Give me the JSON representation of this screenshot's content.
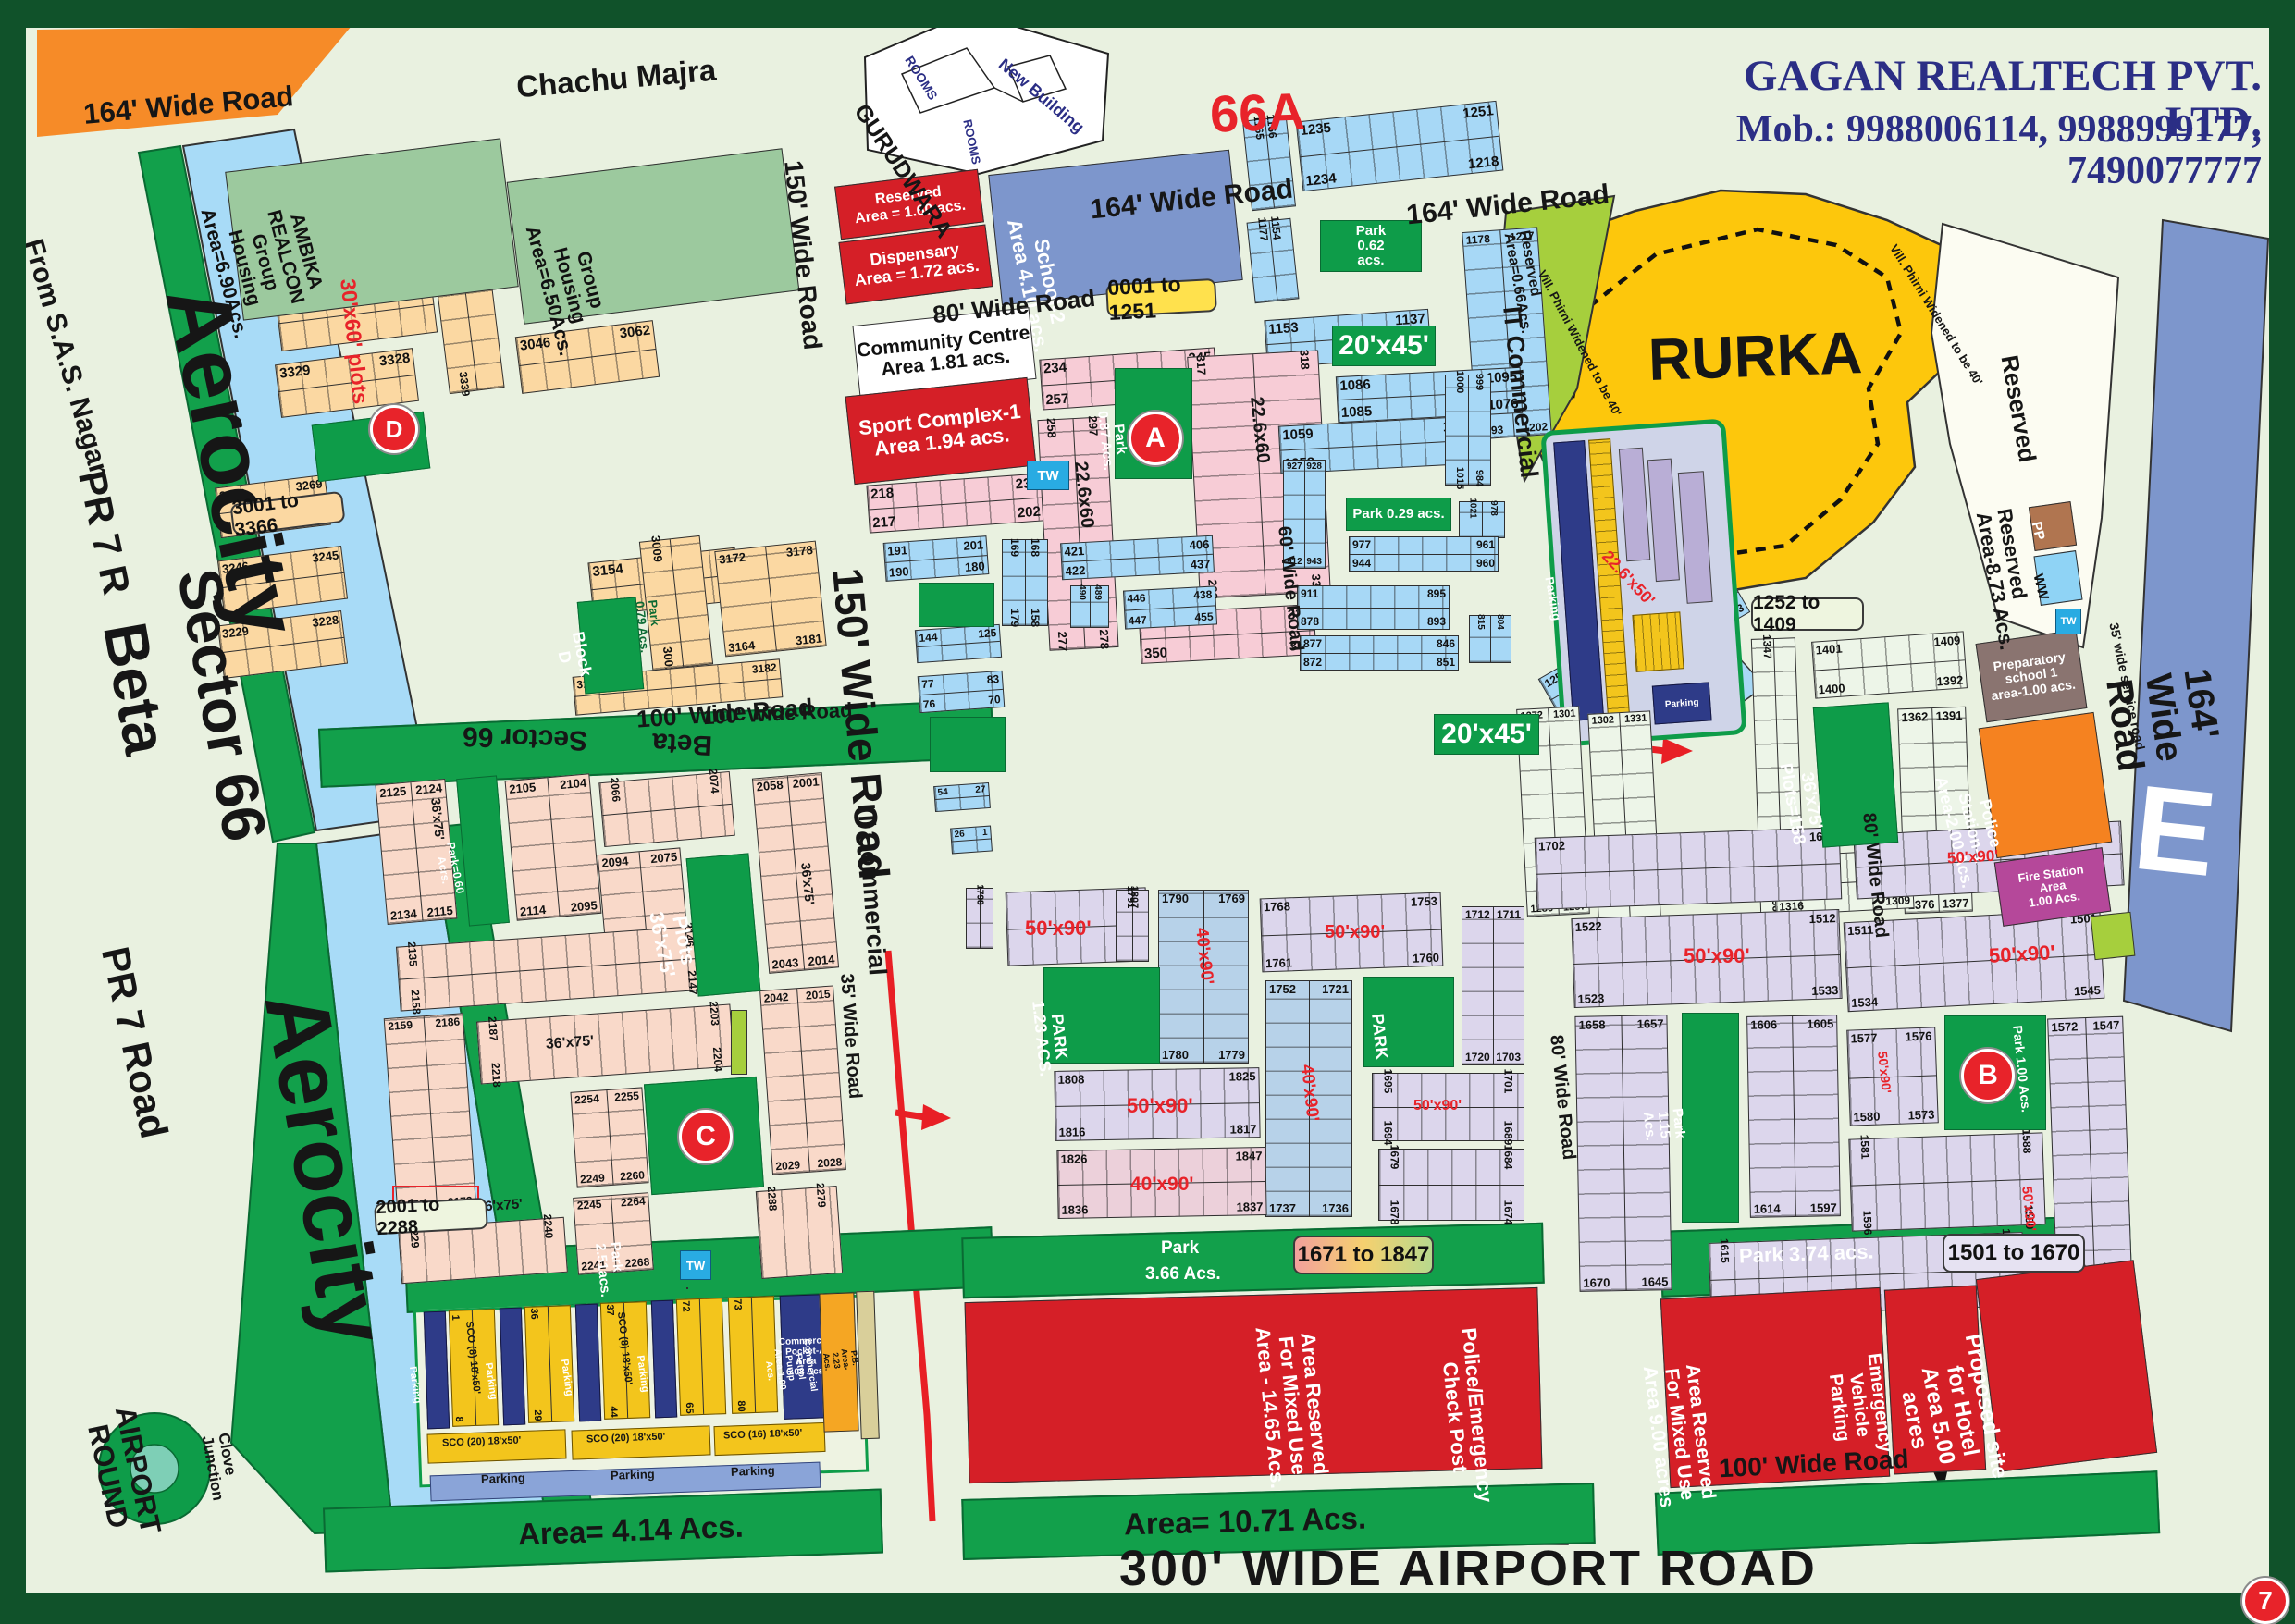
{
  "header": {
    "company": "GAGAN REALTECH PVT. LTD.",
    "phone": "Mob.: 9988006114, 9988999177, 7490077777",
    "sector_code": "66A",
    "village_top": "Chachu Majra",
    "page_no": "7"
  },
  "gurudwara": {
    "name": "GURUDWARA",
    "new_building": "New Building",
    "rooms": "ROOMS"
  },
  "roads": {
    "w164a": "164' Wide  Road",
    "w164b": "164' Wide Road",
    "w164c": "164' Wide Road",
    "w164d": "164' Wide Road",
    "w150a": "150' Wide Road",
    "w150b": "150' Wide Road",
    "w100a": "100' Wide Road",
    "w100b": "100' Wide Road",
    "w80a": "80' Wide Road",
    "w80b": "80' Wide Road",
    "w80c": "80' Wide Road",
    "w60": "60' Wide Road",
    "w35": "35' Wide Road",
    "service35": "35' wide service road",
    "airport": "300' WIDE AIRPORT ROAD",
    "it_comm": "IT Commercial",
    "phirni": "Vill. Phirni Widened to be 40'"
  },
  "left": {
    "from_sas": "From S.A.S. Nagar",
    "pr7r": "PR 7 R",
    "sector66": "Sector 66",
    "beta": "Beta",
    "aerocity": "Aerocity",
    "pr7road": "PR 7 Road",
    "airport_round": "AIRPORT\nROUND",
    "clove": "Clove\nJunction"
  },
  "areas": {
    "ambika": "AMBIKA\nREALCON\nGroup\nHousing\nArea=6.90Acs.",
    "gh650": "Group\nHousing\nArea=6.50Acs.",
    "reserved160": "Reserved\nArea = 1.60 acs.",
    "dispensary": "Dispensary\nArea = 1.72 acs.",
    "school2": "School-2\nArea 4.10 acs.",
    "community": "Community Centre\nArea 1.81 acs.",
    "sport": "Sport Complex-1\nArea 1.94 acs.",
    "rurka": "RURKA",
    "reserved": "Reserved",
    "reserved873": "Reserved\nArea-8.73 Acs.",
    "reserved066": "Reserved\nArea=0.66Acs.",
    "prep_school": "Preparatory\nschool 1\narea-1.00 acs.",
    "police1": "Police Station-1\nArea-2.00 Acs.",
    "fire": "Fire Station\nArea\n1.00 Acs.",
    "pp": "PP",
    "ww": "WW",
    "tw": "TW",
    "e": "E",
    "block_d": "Block\nD",
    "park079": "Park\n0.79 Acs.",
    "mixed1465": "Area Reserved\nFor Mixed Use\nArea - 14.65 Acs.",
    "police_check": "Police/Emergency\nCheck Post",
    "mixed9": "Area Reserved\nFor Mixed Use\nArea 9.00 acres",
    "emergency": "Emergency\nVehicle\nParking",
    "hotel": "Proposed site\nfor Hotel\nArea 5.00 acres",
    "area414": "Area= 4.14 Acs.",
    "area1071": "Area= 10.71 Acs.",
    "petrol": "Commercial\nPetrol Pump\nArea 1.00 Acs.",
    "pb": "P.B. Area- 2.23 Acs.",
    "pocket_a": "Commercial\nPocket-A\nArea\n6.08 Acs.",
    "parking": "Parking",
    "sco8": "SCO (8) 18'x50'",
    "sco20": "SCO (20) 18'x50'",
    "sco16": "SCO (16) 18'x50'"
  },
  "parks": {
    "p251": "Park\n2.51acs.",
    "p366a": "Park",
    "p366b": "3.66 Acs.",
    "p374": "Park 3.74 acs.",
    "p123": "PARK\n1.23 ACS.",
    "p115": "Park\n1.15 Acs.",
    "p100": "Park 1.00 Acs.",
    "p087": "Park\n0.87 Acs.",
    "p062": "Park\n0.62\nacs.",
    "p029": "Park 0.29 acs.",
    "p060": "Park=0.60 Acrs.",
    "plain": "PARK",
    "plots158": "36'x75'\nPlots=158"
  },
  "sizes": {
    "s2045": "20'x45'",
    "s22660": "22.6x60",
    "s22650": "22.6'x50'",
    "s3060": "30'x60' plots",
    "s3675": "36'x75'",
    "plots3675": "Plots 36'x75'",
    "s5090": "50'x90'",
    "s4090": "40'x90'"
  },
  "badges": {
    "b0001": "0001 to 1251",
    "b3001": "3001 to 3366",
    "b1252": "1252 to 1409",
    "b2001": "2001 to 2288",
    "b1671": "1671 to 1847",
    "b1501": "1501 to 1670"
  },
  "markers": {
    "a": "A",
    "b": "B",
    "c": "C",
    "d": "D"
  },
  "blocks": {
    "t1": [
      "1165",
      "1166",
      "",
      ""
    ],
    "t2": [
      "1235",
      "1251",
      "1234",
      "1218"
    ],
    "t3": [
      "1153",
      "1137",
      "1120",
      "1136"
    ],
    "t4": [
      "1178",
      "1217",
      "1193",
      "1202"
    ],
    "t5": [
      "1177",
      "1154",
      "",
      ""
    ],
    "o1": [
      "3366",
      "3345",
      "",
      ""
    ],
    "o2": [
      "3344",
      "",
      "3339",
      ""
    ],
    "o3": [
      "3329",
      "3328",
      "",
      ""
    ],
    "o4": [
      "3270",
      "3269",
      "",
      ""
    ],
    "o5": [
      "3246",
      "3245",
      "",
      ""
    ],
    "o6": [
      "3229",
      "3228",
      "",
      ""
    ],
    "o7": [
      "3046",
      "3062",
      "",
      ""
    ],
    "o8": [
      "3154",
      "",
      "3155",
      ""
    ],
    "o9": [
      "3172",
      "3178",
      "3164",
      "3181"
    ],
    "o10": [
      "3009",
      "",
      "3001",
      ""
    ],
    "o11": [
      "3196",
      "3182",
      "",
      ""
    ],
    "k1": [
      "218",
      "233",
      "217",
      "202"
    ],
    "k2": [
      "234",
      "245",
      "257",
      "246"
    ],
    "k3": [
      "258",
      "297",
      "277",
      "278"
    ],
    "k4": [
      "317",
      "318",
      "298",
      "337"
    ],
    "k5": [
      "349",
      "338",
      "350",
      "361"
    ],
    "u1": [
      "191",
      "201",
      "190",
      "180"
    ],
    "u2": [
      "169",
      "168",
      "179",
      "158"
    ],
    "u3": [
      "421",
      "406",
      "422",
      "437"
    ],
    "u4": [
      "446",
      "438",
      "447",
      "455"
    ],
    "u5": [
      "144",
      "125",
      "",
      ""
    ],
    "u6": [
      "77",
      "83",
      "76",
      "70"
    ],
    "u7": [
      "54",
      "27",
      "",
      ""
    ],
    "u8": [
      "26",
      "1",
      "",
      ""
    ],
    "u9": [
      "1086",
      "1095",
      "1085",
      "1076"
    ],
    "u10": [
      "1059",
      "1075",
      "1058",
      "1042"
    ],
    "u11": [
      "977",
      "961",
      "944",
      "960"
    ],
    "u12": [
      "927",
      "928",
      "912",
      "943"
    ],
    "u13": [
      "1000",
      "999",
      "1015",
      "984"
    ],
    "u14": [
      "1021",
      "978",
      "",
      ""
    ],
    "u15": [
      "490",
      "489",
      "",
      ""
    ],
    "u16": [
      "815",
      "804",
      "",
      ""
    ],
    "u17": [
      "877",
      "846",
      "872",
      "851"
    ],
    "u18": [
      "911",
      "895",
      "878",
      "893"
    ],
    "g0": [
      "1347",
      "",
      "1361",
      ""
    ],
    "g2": [
      "1401",
      "1409",
      "1400",
      "1392"
    ],
    "g3": [
      "1362",
      "1391",
      "1376",
      "1377"
    ],
    "g4": [
      "1317",
      "1324",
      "1316",
      "1309"
    ],
    "g5": [
      "1272",
      "1301",
      "1286",
      "1287"
    ],
    "g6": [
      "1302",
      "1331",
      "",
      ""
    ],
    "g7": [
      "1252",
      "1260",
      "1271",
      "1263"
    ],
    "v1": [
      "1791",
      "1807",
      "",
      ""
    ],
    "v2": [
      "1790",
      "1769",
      "1780",
      "1779"
    ],
    "v3": [
      "1768",
      "1753",
      "1761",
      "1760"
    ],
    "v4": [
      "1712",
      "1711",
      "1720",
      "1703"
    ],
    "v5": [
      "1752",
      "1721",
      "1737",
      "1736"
    ],
    "v6": [
      "1808",
      "1825",
      "1816",
      "1817"
    ],
    "v7": [
      "1826",
      "1847",
      "1836",
      "1837"
    ],
    "v8": [
      "1695",
      "1701",
      "1694",
      "1689"
    ],
    "v9": [
      "1679",
      "1684",
      "1678",
      "1674"
    ],
    "v10": [
      "1702",
      "1687",
      "",
      ""
    ],
    "v12": [
      "1798",
      "1799",
      "",
      ""
    ],
    "w1": [
      "1522",
      "1512",
      "1523",
      "1533"
    ],
    "w2": [
      "1511",
      "1501",
      "1534",
      "1545"
    ],
    "w3": [
      "1658",
      "1657",
      "1670",
      "1645"
    ],
    "w4": [
      "1606",
      "1605",
      "1614",
      "1597"
    ],
    "w5": [
      "1577",
      "1576",
      "1580",
      "1573"
    ],
    "w6": [
      "1581",
      "1588",
      "1596",
      "1589"
    ],
    "w7": [
      "1572",
      "1547",
      "1560",
      "1559"
    ],
    "w8": [
      "1615",
      "1629",
      "1644",
      "1630"
    ],
    "m1": [
      "2125",
      "2124",
      "2134",
      "2115"
    ],
    "m2": [
      "2105",
      "2104",
      "2114",
      "2095"
    ],
    "m3": [
      "2066",
      "2074",
      "",
      ""
    ],
    "m4": [
      "2094",
      "2075",
      "2085",
      "2084"
    ],
    "m5": [
      "2058",
      "2001",
      "2043",
      "2014"
    ],
    "m6": [
      "2135",
      "2146",
      "2158",
      "2147"
    ],
    "m7": [
      "2159",
      "2186",
      "2172",
      "2173"
    ],
    "m8": [
      "2187",
      "2203",
      "2218",
      "2204"
    ],
    "m9": [
      "2254",
      "2255",
      "2249",
      "2260"
    ],
    "m10": [
      "2245",
      "2264",
      "2241",
      "2268"
    ],
    "m11": [
      "2042",
      "2015",
      "2029",
      "2028"
    ],
    "m13": [
      "2229",
      "2240",
      "",
      ""
    ],
    "m14": [
      "2288",
      "2279",
      "",
      ""
    ],
    "sc1": [
      "1",
      "",
      "8",
      ""
    ],
    "sc2": [
      "36",
      "",
      "29",
      ""
    ],
    "sc3": [
      "37",
      "",
      "44",
      ""
    ],
    "sc4": [
      "72",
      "",
      "65",
      ""
    ],
    "sc5": [
      "73",
      "",
      "80",
      ""
    ]
  }
}
